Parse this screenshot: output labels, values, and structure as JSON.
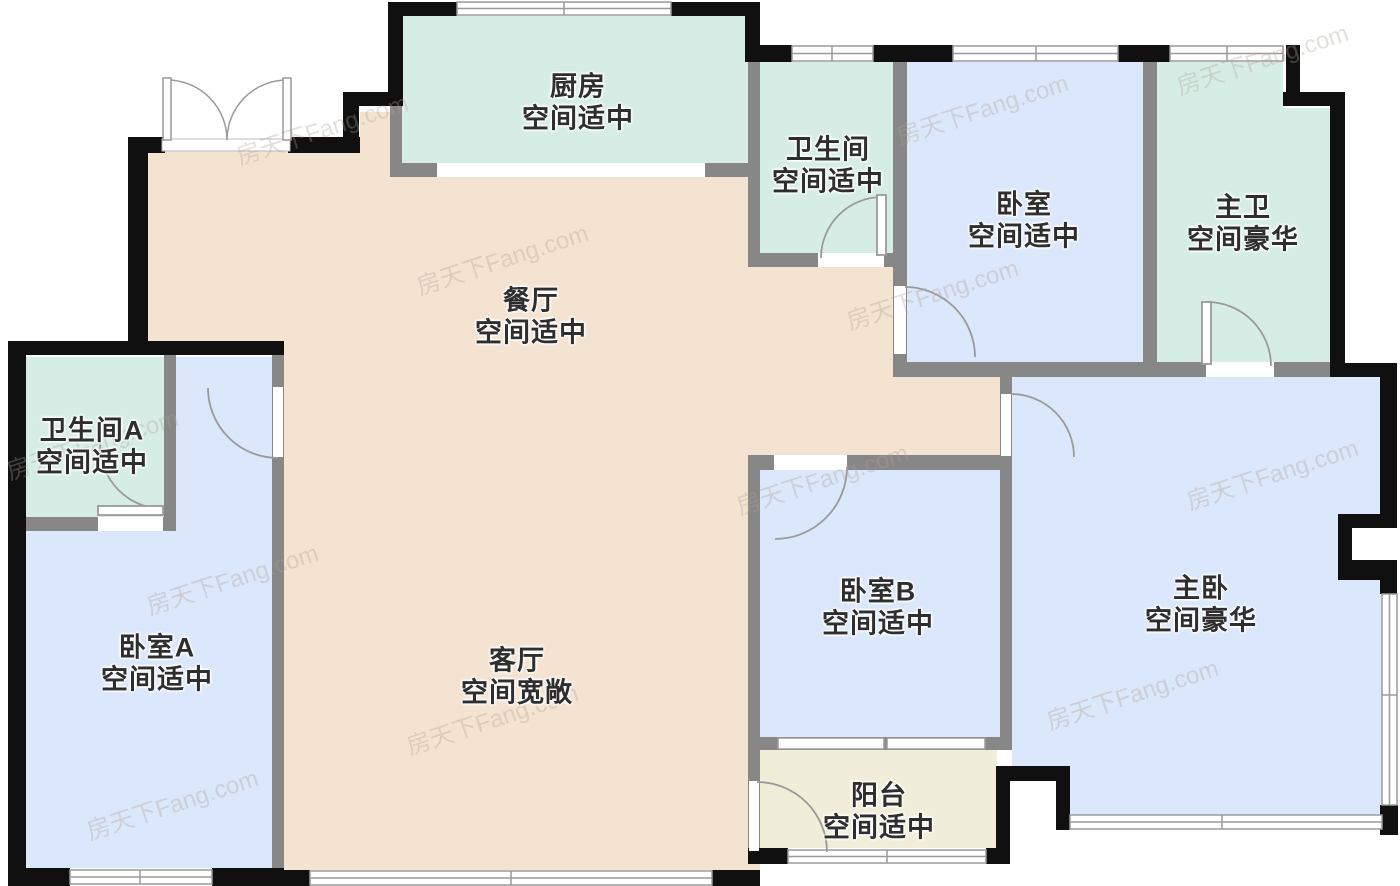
{
  "title": "户型图",
  "watermark": {
    "text": "房天下Fang.com"
  },
  "palette": {
    "wall_outer": "#101010",
    "wall_inner": "#878787",
    "floor_public": "#f4e3d1",
    "floor_bedroom": "#dbe7fa",
    "floor_bath": "#d6ede6",
    "floor_balcony": "#f0eed8",
    "window_fill": "#ffffff",
    "window_line": "#9a9a9a",
    "label_text": "#2e2e2e"
  },
  "rooms": [
    {
      "id": "kitchen",
      "name": "厨房",
      "assessment": "空间适中"
    },
    {
      "id": "bathroom",
      "name": "卫生间",
      "assessment": "空间适中"
    },
    {
      "id": "bedroom",
      "name": "卧室",
      "assessment": "空间适中"
    },
    {
      "id": "master-bath",
      "name": "主卫",
      "assessment": "空间豪华"
    },
    {
      "id": "dining",
      "name": "餐厅",
      "assessment": "空间适中"
    },
    {
      "id": "bathroom-a",
      "name": "卫生间A",
      "assessment": "空间适中"
    },
    {
      "id": "bedroom-a",
      "name": "卧室A",
      "assessment": "空间适中"
    },
    {
      "id": "living",
      "name": "客厅",
      "assessment": "空间宽敞"
    },
    {
      "id": "bedroom-b",
      "name": "卧室B",
      "assessment": "空间适中"
    },
    {
      "id": "master-bedroom",
      "name": "主卧",
      "assessment": "空间豪华"
    },
    {
      "id": "balcony",
      "name": "阳台",
      "assessment": "空间适中"
    }
  ]
}
